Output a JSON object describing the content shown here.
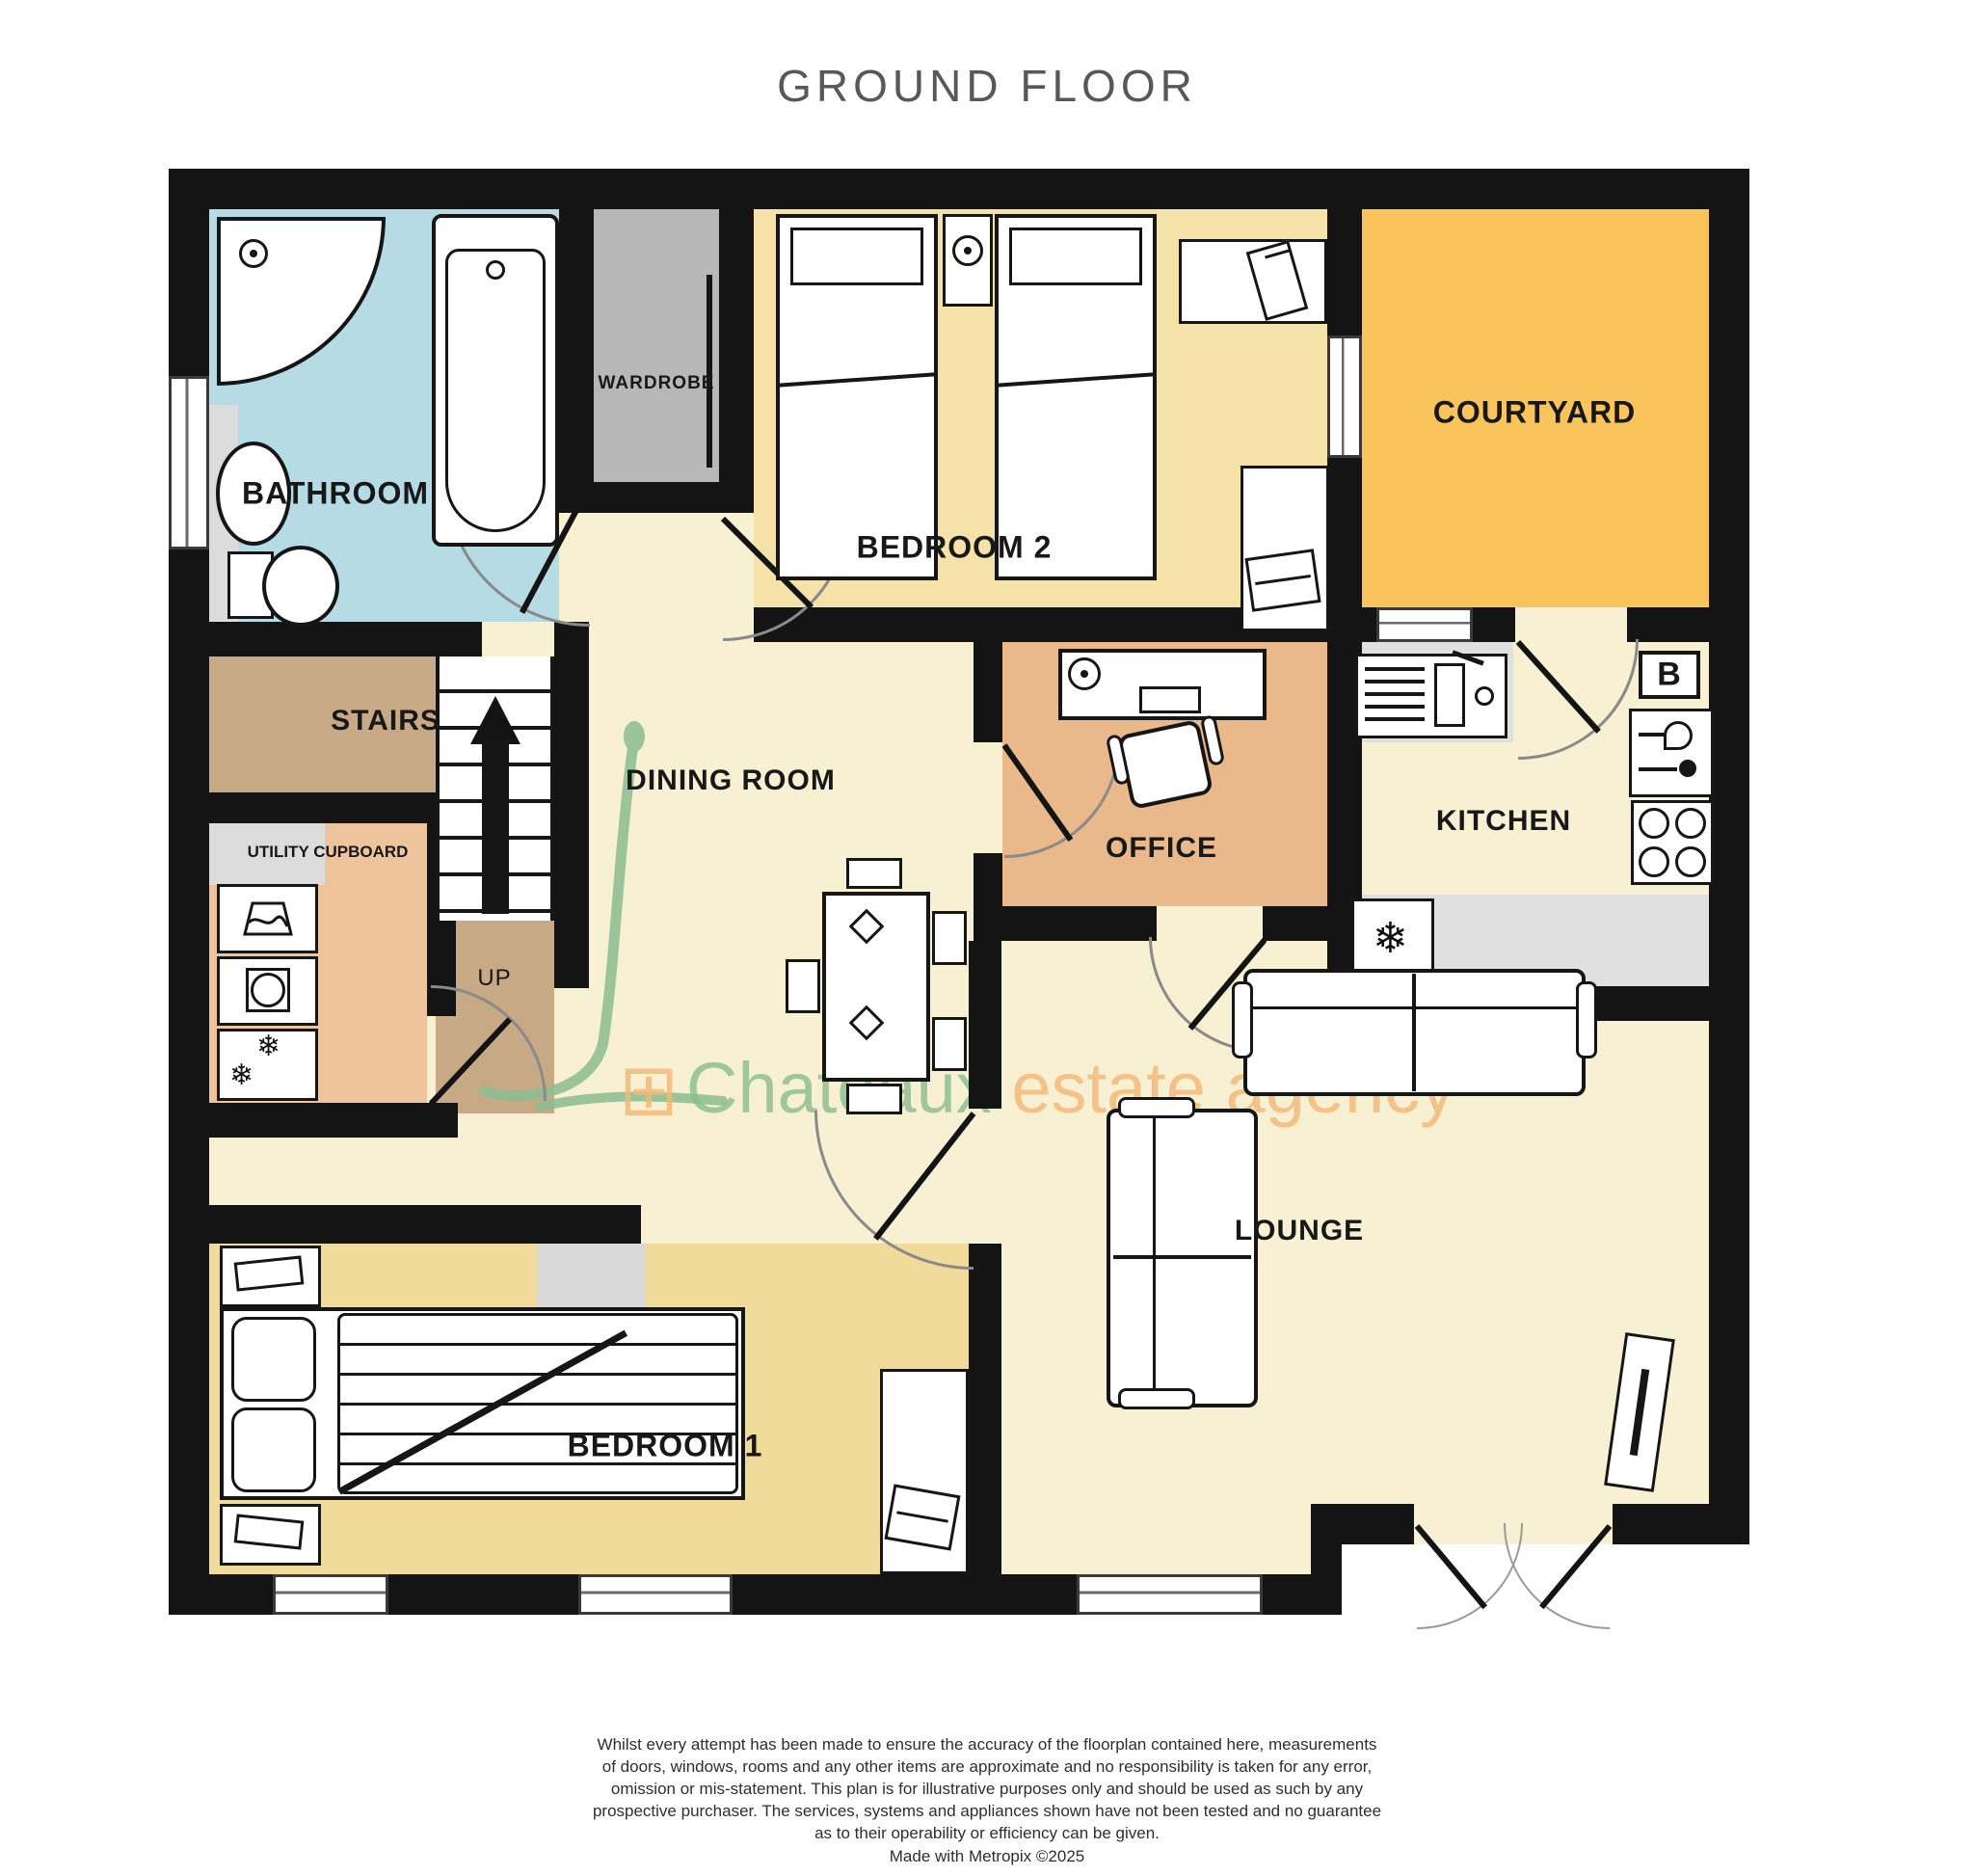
{
  "title": "GROUND FLOOR",
  "rooms": {
    "bathroom": {
      "label": "BATHROOM",
      "color": "#b5dbe4"
    },
    "wardrobe": {
      "label": "WARDROBE",
      "color": "#b7b7b7"
    },
    "bedroom2": {
      "label": "BEDROOM 2",
      "color": "#f5e2a9"
    },
    "courtyard": {
      "label": "COURTYARD",
      "color": "#f9c45c"
    },
    "stairs": {
      "label": "STAIRS",
      "color": "#c7a985"
    },
    "landing": {
      "label": "UP",
      "color": "#c7a985"
    },
    "utility": {
      "label": "UTILITY CUPBOARD",
      "color": "#eec49c"
    },
    "dining": {
      "label": "DINING ROOM",
      "color": "#f7f0d3"
    },
    "office": {
      "label": "OFFICE",
      "color": "#e9b88b"
    },
    "kitchen": {
      "label": "KITCHEN",
      "color": "#f7f0d3"
    },
    "lounge": {
      "label": "LOUNGE",
      "color": "#f7f0d3"
    },
    "bedroom1": {
      "label": "BEDROOM 1",
      "color": "#f1db9b"
    }
  },
  "kitchen_badges": {
    "boiler": "B"
  },
  "icons": {
    "freezer_snowflake": "❄",
    "fridge_snowflake": "❄"
  },
  "watermark": {
    "logo_icon": "window-grid-icon",
    "brand": "Chateaux",
    "suffix": " estate agency",
    "green": "#8cbd92",
    "orange": "#f4b877"
  },
  "disclaimer": {
    "lines": [
      "Whilst every attempt has been made to ensure the accuracy of the floorplan contained here, measurements",
      "of doors, windows, rooms and any other items are approximate and no responsibility is taken for any error,",
      "omission or mis-statement. This plan is for illustrative purposes only and should be used as such by any",
      "prospective purchaser. The services, systems and appliances shown have not been tested and no guarantee",
      "as to their operability or efficiency can be given.",
      "Made with Metropix ©2025"
    ]
  }
}
